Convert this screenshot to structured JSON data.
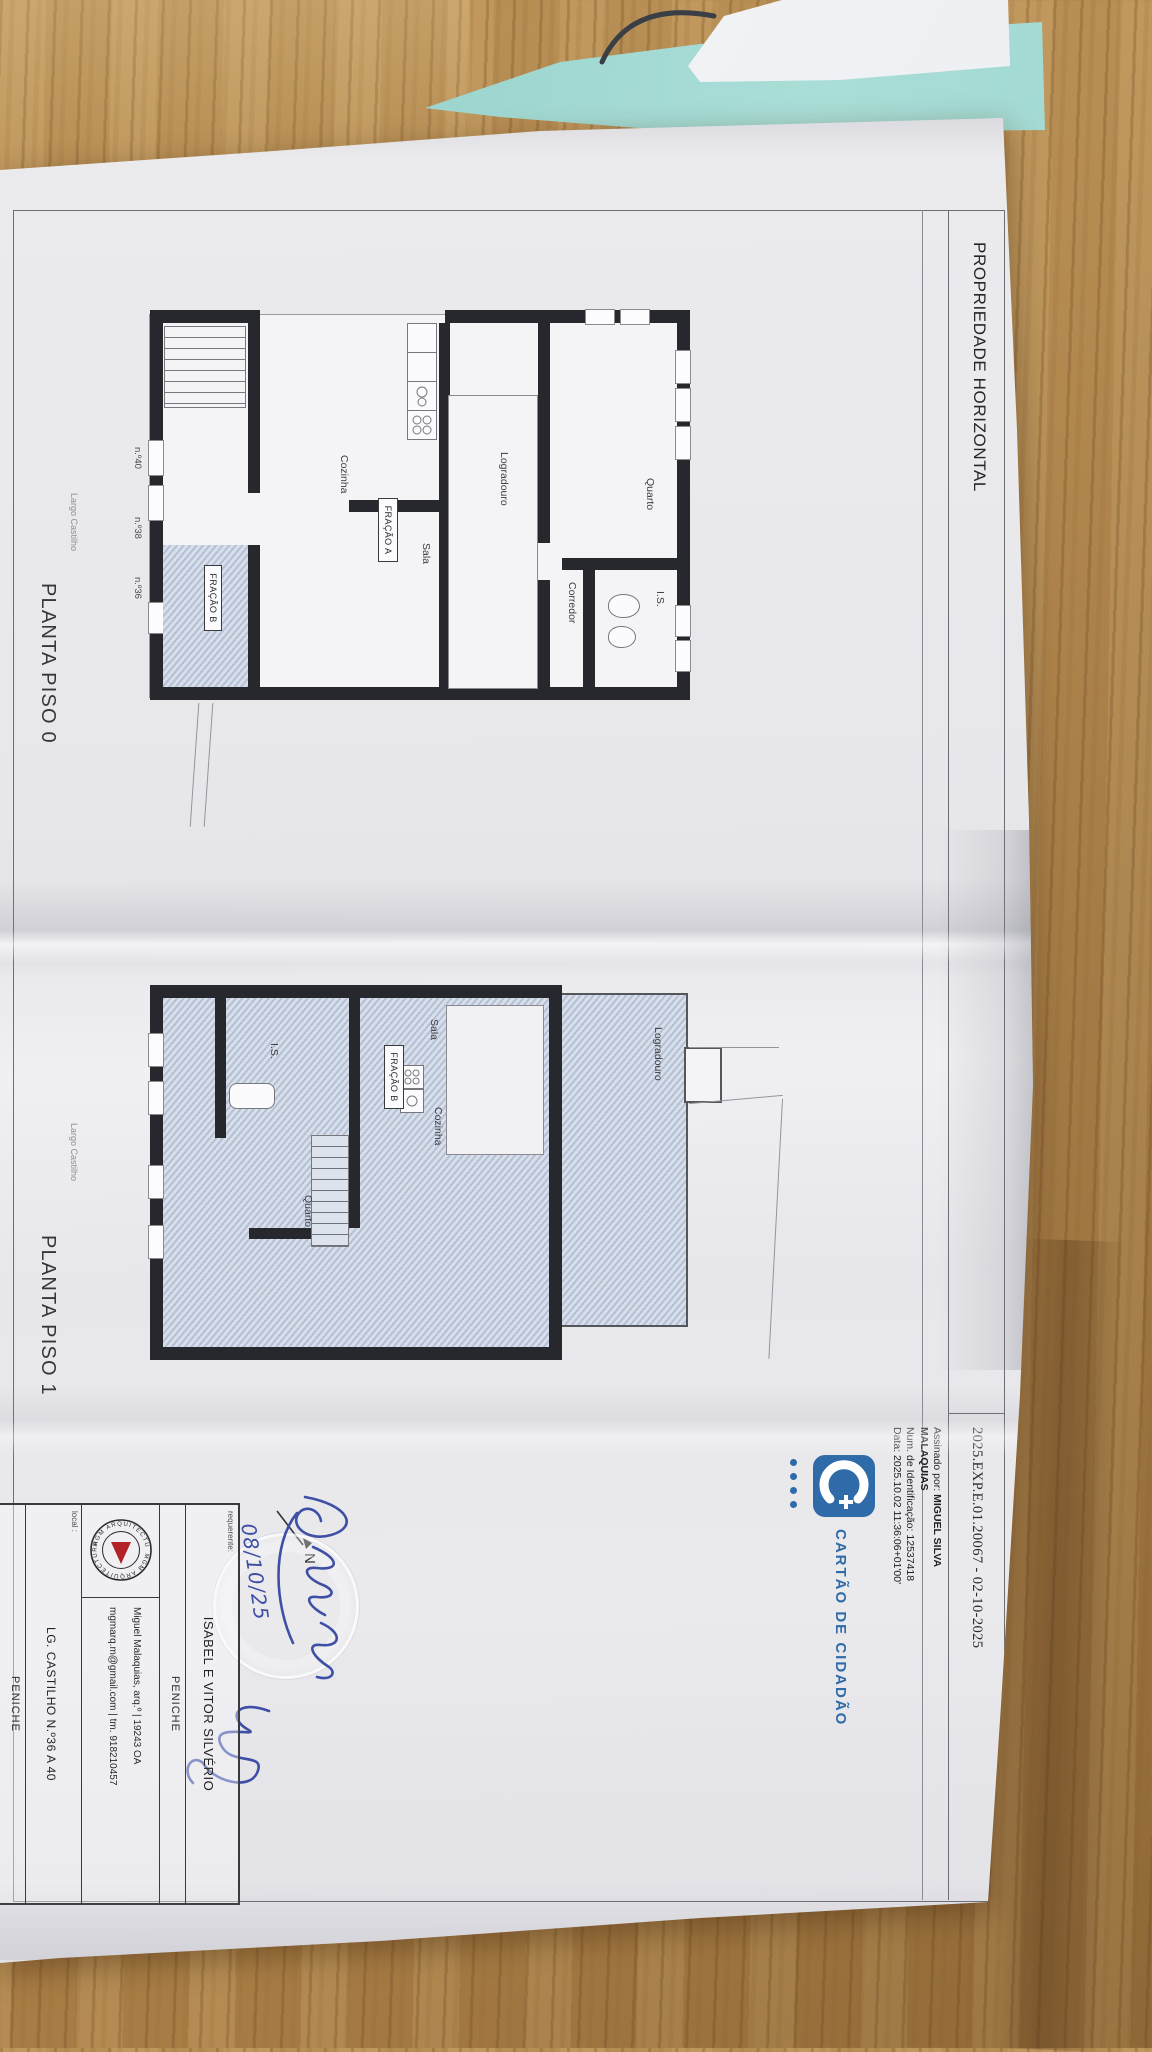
{
  "header": {
    "title": "PROPRIEDADE HORIZONTAL",
    "reference": "2025.EXP.E.01.20067 - 02-10-2025"
  },
  "signature": {
    "assinado_label": "Assinado por: ",
    "name1": "MIGUEL SILVA",
    "name2": "MALAQUIAS",
    "id_line": "Num. de Identificação: 12537418",
    "date_line": "Data: 2025.10.02 11:36:06+01'00'"
  },
  "citizen_card": {
    "label": "CARTÃO DE CIDADÃO"
  },
  "plans": {
    "piso0": {
      "caption": "PLANTA PISO 0",
      "street": "Largo Castilho",
      "unit_a": "FRAÇÃO A",
      "unit_b": "FRAÇÃO B",
      "rooms": {
        "quarto": "Quarto",
        "is": "I.S.",
        "corredor": "Corredor",
        "logradouro": "Logradouro",
        "sala": "Sala",
        "cozinha": "Cozinha"
      },
      "numbers": {
        "n40": "n.º40",
        "n38": "n.º38",
        "n36": "n.º36"
      }
    },
    "piso1": {
      "caption": "PLANTA PISO 1",
      "street": "Largo Castilho",
      "unit_b": "FRAÇÃO B",
      "rooms": {
        "logradouro": "Logradouro",
        "sala": "Sala",
        "cozinha": "Cozinha",
        "is": "I.S.",
        "quarto": "Quarto"
      }
    }
  },
  "title_block": {
    "requerente_label": "requerente:",
    "requerente": "ISABEL E VITOR SILVÉRIO",
    "city1": "PENICHE",
    "logo_text": "MGM ARQUITECTURA",
    "architect_line": "Miguel Malaquias, arq.º   |   19243 OA",
    "contact_line": "mgmarq.m@gmail.com   |   tm. 918210457",
    "local_label": "local :",
    "local_value": "LG. CASTILHO N.º36 A 40",
    "city2": "PENICHE"
  },
  "annotations": {
    "north": "N",
    "handwritten_date": "08/10/25"
  },
  "colors": {
    "cc_blue": "#2e6ba8",
    "ink_blue": "#3e4fa5",
    "logo_red": "#b22228",
    "hatch_blue": "#b4c0d4",
    "wall_dark": "#26282e",
    "teal_paper": "#9ad0c9",
    "wood": "#b0854b"
  }
}
